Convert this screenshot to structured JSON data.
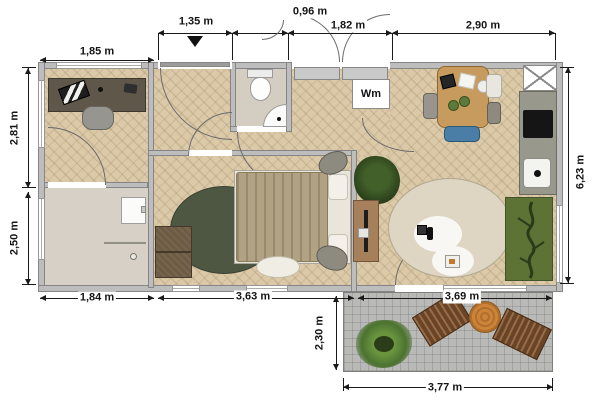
{
  "plan": {
    "type": "floor-plan",
    "dimensions": {
      "office_width": "1,85 m",
      "entry_door_width": "1,35 m",
      "wc_width": "0,96 m",
      "entry_width": "1,82 m",
      "kitchen_width": "2,90 m",
      "office_height": "2,81 m",
      "utility_height": "2,50 m",
      "building_height": "6,23 m",
      "utility_width": "1,84 m",
      "bedroom_width": "3,63 m",
      "living_width": "3,69 m",
      "patio_height": "2,30 m",
      "patio_width": "3,77 m"
    },
    "labels": {
      "washing_machine": "Wm"
    },
    "colors": {
      "floor_wood": "#dbc9a8",
      "floor_utility": "#d6d0c6",
      "wall": "#bdbdbd",
      "patio": "#b9b9b7",
      "bedroom_rug": "#4e5742",
      "living_rug": "#ded5c2",
      "green_rug": "#5d7335",
      "dining_table_wood": "#c79a5e",
      "dining_chair_blue": "#4a7ea6",
      "lounger_brown": "#6b4426",
      "patio_table_orange": "#c8813a",
      "dimension_text": "#141414"
    },
    "furniture": [
      "desk",
      "office-chair",
      "laptop",
      "utility-washbasin",
      "toilet",
      "corner-sink",
      "washing-machine",
      "entry-double-door",
      "bed",
      "bedroom-rug",
      "dresser",
      "pouf-stones",
      "tv-console",
      "potted-plant",
      "dining-table",
      "dining-chairs",
      "kitchen-counter",
      "cooktop",
      "kitchen-sink",
      "vent-shaft",
      "round-rug",
      "green-rug",
      "patio-plant",
      "sun-loungers",
      "patio-round-table"
    ]
  }
}
